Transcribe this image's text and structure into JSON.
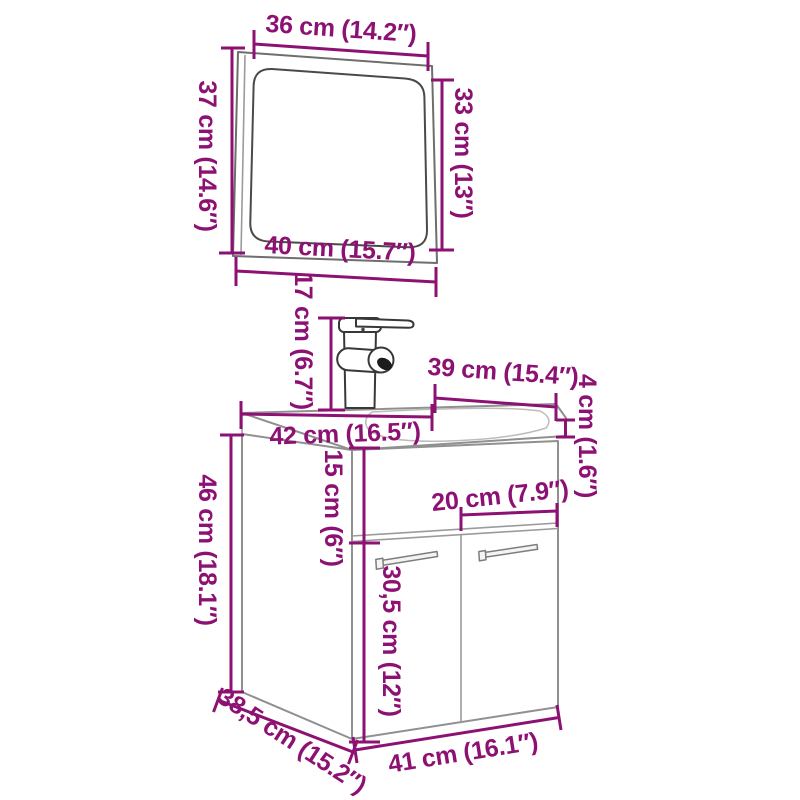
{
  "diagram": {
    "title": "bathroom furniture set dimension diagram",
    "items": [
      "mirror",
      "faucet",
      "sink cabinet"
    ],
    "colors": {
      "dimension_accent": "#8d1173",
      "outline_dark": "#383838",
      "outline_mid": "#909090",
      "background": "#ffffff"
    },
    "labels": {
      "mirror_width_top": "36 cm (14.2″)",
      "mirror_height_left": "37 cm (14.6″)",
      "mirror_height_right": "33 cm (13″)",
      "mirror_width_bottom": "40 cm (15.7″)",
      "faucet_height": "17 cm (6.7″)",
      "counter_depth": "39 cm (15.4″)",
      "counter_thickness": "4 cm (1.6″)",
      "counter_width": "42 cm (16.5″)",
      "apron_height": "15 cm (6″)",
      "door_width": "20 cm (7.9″)",
      "door_height": "30,5 cm (12″)",
      "cabinet_height": "46 cm (18.1″)",
      "cabinet_depth": "38,5 cm (15.2″)",
      "cabinet_width": "41 cm (16.1″)"
    }
  }
}
